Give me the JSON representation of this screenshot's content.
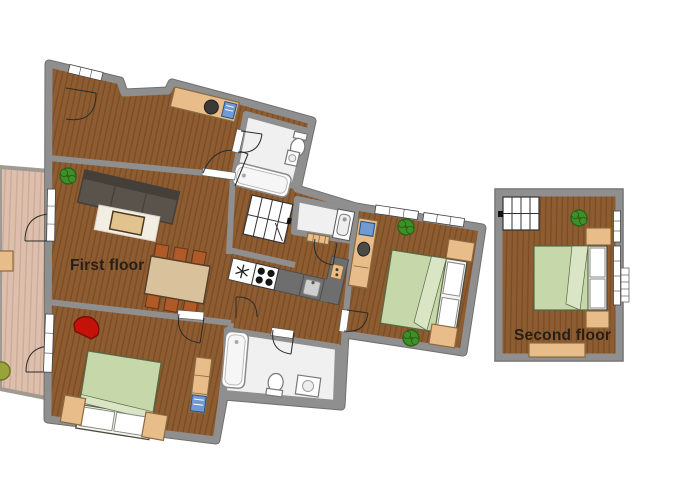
{
  "labels": {
    "first_floor": "First floor",
    "second_floor": "Second floor"
  },
  "colors": {
    "background": "#ffffff",
    "wood": "#8d5c31",
    "wood_stripe": "#7a4c26",
    "terrace": "#dcc0ad",
    "terrace_stripe": "#cdab96",
    "wall": "#8f8f8f",
    "wall_edge": "#6f6f6f",
    "bath_floor": "#f0f0f0",
    "bed": "#c6d7aa",
    "bed_fold": "#d9e5c4",
    "pillow": "#ffffff",
    "tan": "#e9bd89",
    "tan_dark": "#8a6a40",
    "table": "#d9c19c",
    "chair": "#b05a28",
    "sofa": "#59534b",
    "sofa_dark": "#443f38",
    "rug": "#f3eee3",
    "coffee_table": "#e2c28d",
    "red_chair": "#c41208",
    "plant": "#3f8f28",
    "plant_dark": "#2a6316",
    "terrace_plant": "#9aa33a",
    "counter": "#6e6e6e",
    "counter_dark": "#4d4d4d",
    "computer_blue": "#6f9bd2",
    "stairs": "#ffffff",
    "text": "#261f17"
  },
  "elements": {
    "bed": "rect-with-pillows",
    "plant": "circle-cluster",
    "stairs": "grid-rect",
    "stove": "four-burner-circles",
    "fridge": "snowflake-square",
    "sink": "basin-square",
    "bathtub": "rounded-rect",
    "toilet": "ellipse-with-tank",
    "door": "quarter-arc",
    "window": "white-strip"
  }
}
